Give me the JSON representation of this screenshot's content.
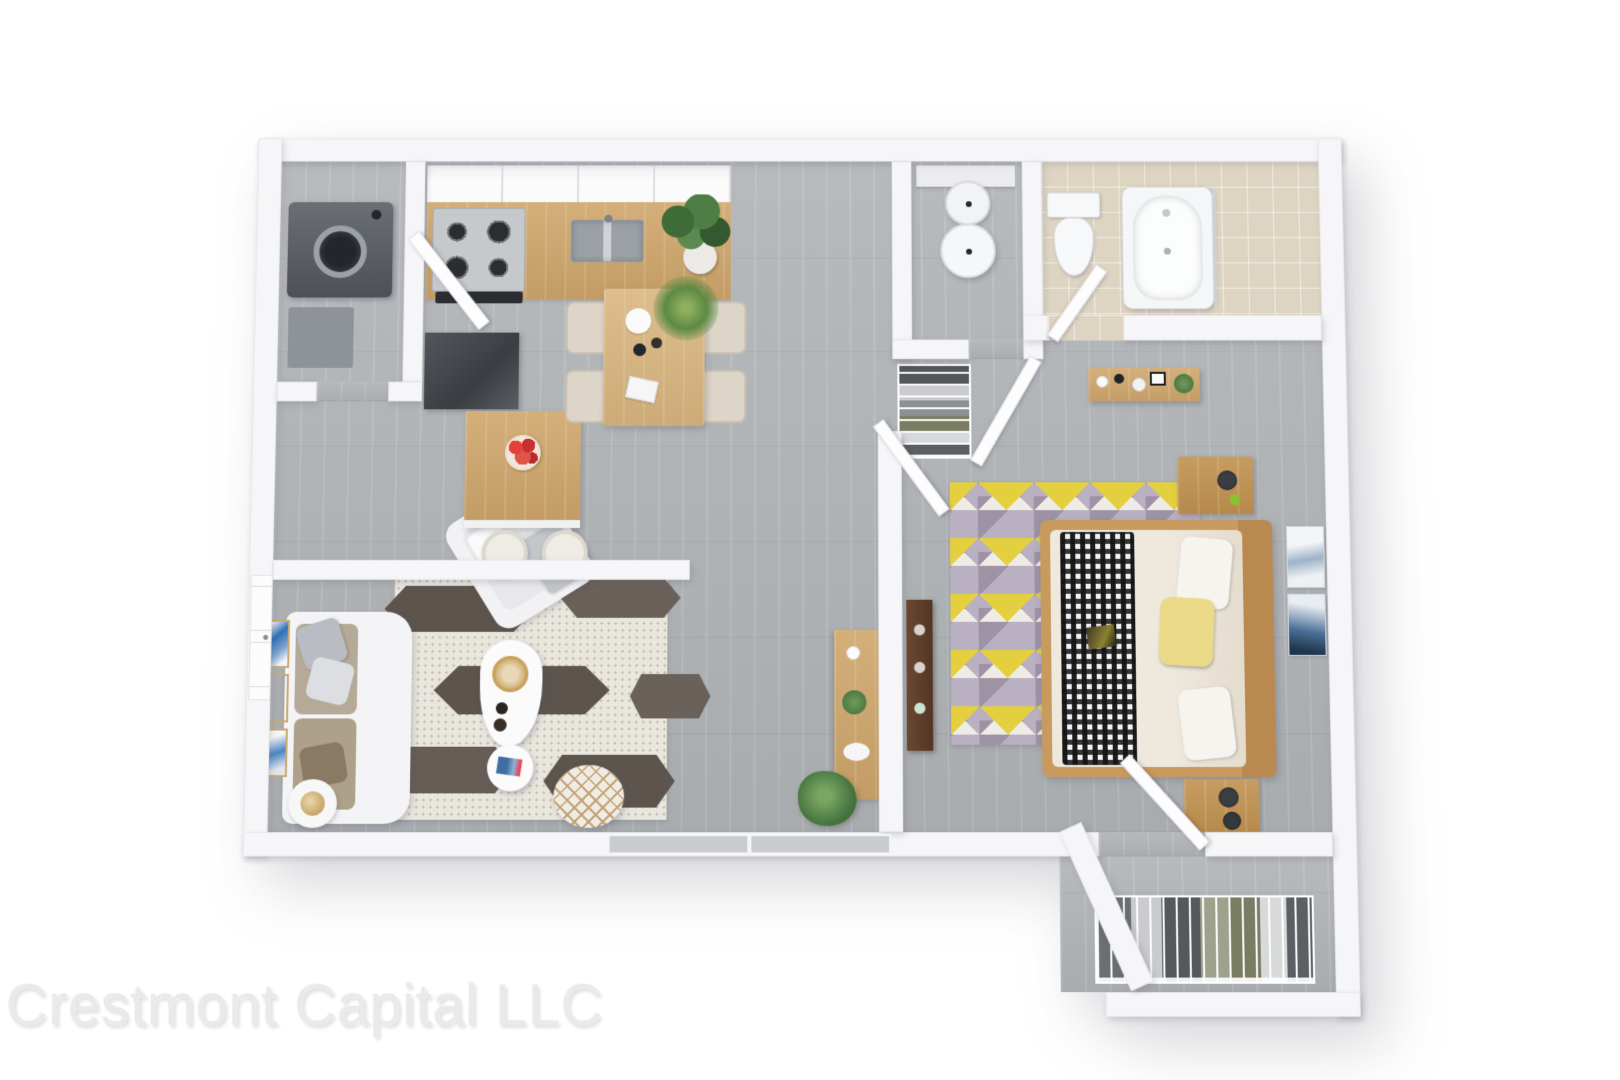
{
  "watermark": {
    "text": "Crestmont Capital LLC"
  },
  "palette": {
    "background": "#ffffff",
    "wall": "#f6f6f8",
    "wall_edge": "#e9e9ee",
    "floor_wood_gray": "#b1b5b8",
    "floor_tile_beige": "#ded4c2",
    "wood_light": "#cfa66b",
    "wood_frame": "#c89a5e",
    "wood_dark": "#5e3f2b",
    "appliance_steel": "#c6c9cc",
    "appliance_dark": "#54585e",
    "rug_living_base": "#e9e6de",
    "rug_living_dark": "#5c544d",
    "rug_bedroom_base": "#b9b0c2",
    "rug_triangle_yellow": "#e4cf3f",
    "pillow_yellow": "#ead987",
    "artwork_blue": "#2f6fb5",
    "plant_green": "#4e7d46",
    "sofa_cushion": "#b5aa97",
    "watermark_gray": "#eaeaea"
  },
  "scene": {
    "type": "3d-rendered-floor-plan",
    "view": "top-down dollhouse, one-bedroom apartment",
    "rooms": [
      {
        "name": "laundry-closet",
        "furnishings": [
          "washing-machine",
          "laundry-cabinet"
        ]
      },
      {
        "name": "kitchen",
        "furnishings": [
          "upper-cabinets",
          "gas-stove",
          "oven-front",
          "wood-countertop",
          "double-sink",
          "dark-counter",
          "kitchen-island",
          "fruit-bowl-apples",
          "bar-stool-left",
          "bar-stool-right"
        ]
      },
      {
        "name": "dining-area",
        "furnishings": [
          "dining-table",
          "dining-chairs-x4",
          "monstera-plant",
          "palm-plant",
          "table-magazine"
        ]
      },
      {
        "name": "powder-nook",
        "furnishings": [
          "pedestal-sink",
          "vanity-slab"
        ]
      },
      {
        "name": "bathroom",
        "furnishings": [
          "toilet",
          "bathtub",
          "glass-screen"
        ]
      },
      {
        "name": "hallway",
        "furnishings": [
          "wire-wardrobe"
        ]
      },
      {
        "name": "bedroom",
        "furnishings": [
          "double-bed",
          "checkered-throw",
          "white-pillows-x2",
          "yellow-pillow",
          "nightstand-top",
          "nightstand-bottom",
          "black-lamps",
          "vanity-shelf",
          "triangle-rug",
          "media-dresser",
          "leaning-artwork"
        ]
      },
      {
        "name": "living-room",
        "furnishings": [
          "sofa",
          "throw-pillows",
          "armchair",
          "armchair-throw",
          "coffee-table",
          "gold-tray",
          "side-table",
          "magazines-blue",
          "diamond-pouf",
          "lamp-side-table",
          "hexagon-rug",
          "tv-console",
          "tv",
          "artwork-triptych-blue",
          "floor-plant"
        ]
      },
      {
        "name": "walk-in-closet",
        "furnishings": [
          "wire-shelving-with-clothes"
        ]
      }
    ],
    "doors": [
      "entry-door",
      "laundry-door",
      "bathroom-door",
      "bedroom-door",
      "hall-door",
      "closet-door"
    ],
    "window": "wide-window-bottom-wall"
  }
}
